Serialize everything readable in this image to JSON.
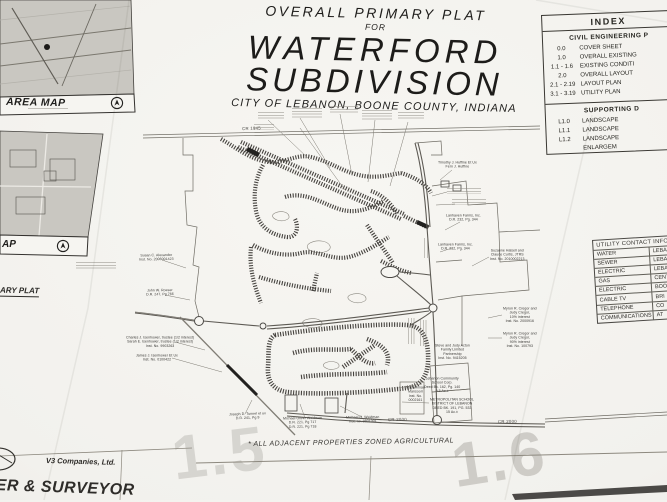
{
  "title_block": {
    "line1": "OVERALL PRIMARY PLAT",
    "line2": "FOR",
    "line3": "WATERFORD",
    "line4": "SUBDIVISION",
    "line5": "CITY OF LEBANON, BOONE COUNTY, INDIANA"
  },
  "index_table": {
    "title": "INDEX",
    "civil_header": "CIVIL ENGINEERING P",
    "civil_rows": [
      {
        "sheet": "0.0",
        "name": "COVER SHEET"
      },
      {
        "sheet": "1.0",
        "name": "OVERALL EXISTING"
      },
      {
        "sheet": "1.1 - 1.6",
        "name": "EXISTING CONDITI"
      },
      {
        "sheet": "2.0",
        "name": "OVERALL LAYOUT"
      },
      {
        "sheet": "2.1 - 2.19",
        "name": "LAYOUT PLAN"
      },
      {
        "sheet": "3.1 - 3.19",
        "name": "UTILITY PLAN"
      }
    ],
    "supporting_header": "SUPPORTING D",
    "supporting_rows": [
      {
        "sheet": "L1.0",
        "name": "LANDSCAPE"
      },
      {
        "sheet": "L1.1",
        "name": "LANDSCAPE"
      },
      {
        "sheet": "L1.2",
        "name": "LANDSCAPE"
      },
      {
        "sheet": "",
        "name": "ENLARGEM"
      }
    ]
  },
  "utility_table": {
    "header": "UTILITY CONTACT INFOR",
    "rows": [
      {
        "k": "WATER",
        "v": "LEBANO"
      },
      {
        "k": "SEWER",
        "v": "LEBANO"
      },
      {
        "k": "ELECTRIC",
        "v": "LEBAN"
      },
      {
        "k": "GAS",
        "v": "CENTE"
      },
      {
        "k": "ELECTRIC",
        "v": "BOON"
      },
      {
        "k": "CABLE TV",
        "v": "BRI"
      },
      {
        "k": "TELEPHONE",
        "v": "CO"
      },
      {
        "k": "COMMUNICATIONS",
        "v": "AT"
      }
    ]
  },
  "area_maps": {
    "map1_label": "AREA MAP",
    "map2_label": "AP",
    "partial_title": "ARY PLAT"
  },
  "map_annotations": [
    {
      "text": "Susan C. Alexander\nInst. No. 2006001423"
    },
    {
      "text": "John W. Roeser\nD.R. 247, Pg 766"
    },
    {
      "text": "Charles J. Isenhower, trustee (1/2 interest)\nSarah E. Isenhower, trustee (1/2 interest)\nInst. No. 9903263"
    },
    {
      "text": "James J. Isenhower Et Ux\nInst. No. 0100422"
    },
    {
      "text": "Joseph D. Tunnel et ux\nD.R. 241, Pg 9"
    },
    {
      "text": "Michael Oliver Weidman\nD.R. 221, Pg 717\nD.R. 221, Pg 718"
    },
    {
      "text": "Michael O. Weidman\nInst. no. 9801001"
    },
    {
      "text": "Lebanon Community\nSchool Corp.\nDeed Bk. 162, Pg. 140\n9.5 Ac.±"
    },
    {
      "text": "METROPOLITAN SCHOOL\nDISTRICT OF LEBANON\nDEED BK. 191, PG. 533\n15 Ac.±"
    },
    {
      "text": "Mohammad\nMansoori\nInst. No.\n0002161"
    },
    {
      "text": "Steve and Judy Acton\nFamily Limited\nPartnership\nInst. No. 9415205"
    },
    {
      "text": "Myron R. Cregor and\nJudy Cregor,\n10% interest\nInst. No. 2000916"
    },
    {
      "text": "Myron R. Cregor and\nJudy Cregor,\n90% interest\nInst. No. 100793"
    },
    {
      "text": "Lanhaven Farms, Inc.\nD.R. 232, Pg. 344"
    },
    {
      "text": "Lanhaven Farms, Inc.\nD.R. 232, Pg. 344"
    },
    {
      "text": "Suzanne Halsell and\nClaude Curtis, JTRS\nInst. No. 2010002213"
    },
    {
      "text": "Timothy J. Huffine Et Ux\nFern J. Huffine"
    }
  ],
  "road_labels": [
    {
      "text": "CR 1945"
    },
    {
      "text": "CR 2000"
    },
    {
      "text": "CR 2000"
    }
  ],
  "footer": {
    "note": "* ALL ADJACENT PROPERTIES ZONED AGRICULTURAL",
    "company": "V3 Companies, Ltd.",
    "partial_title": "ER & SURVEYOR"
  },
  "watermarks": {
    "left": "1.5",
    "right": "1.6"
  }
}
